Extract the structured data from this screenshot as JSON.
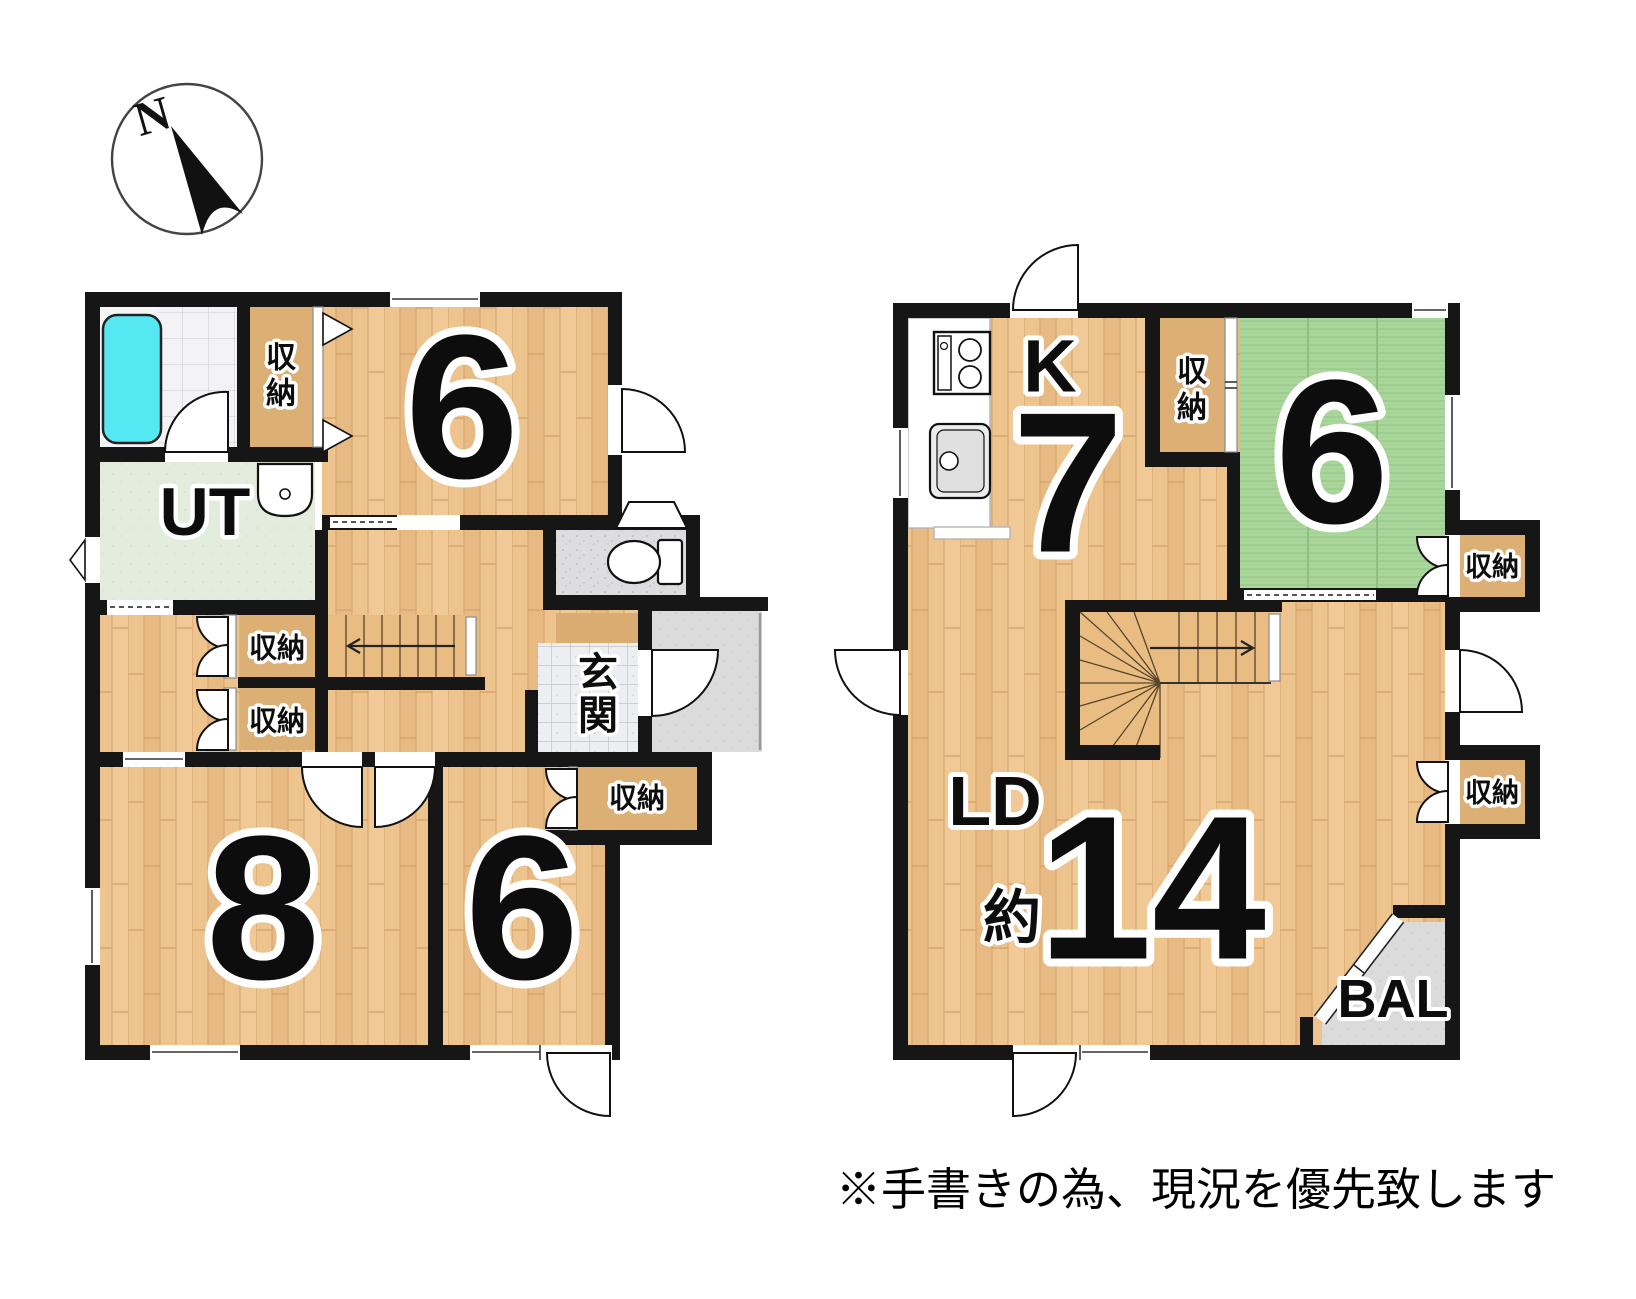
{
  "compass": {
    "north_label": "N"
  },
  "labels": {
    "storage": "収納",
    "storage_chars": [
      "収",
      "納"
    ],
    "entrance_chars": [
      "玄",
      "関"
    ],
    "utility": "UT",
    "kitchen": "K",
    "living_dining": "LD",
    "approx": "約",
    "balcony": "BAL"
  },
  "floor1": {
    "bedroom_top_size": "6",
    "bedroom_left_size": "8",
    "bedroom_right_size": "6"
  },
  "floor2": {
    "kitchen_size": "7",
    "tatami_size": "6",
    "living_size": "14"
  },
  "note": "※手書きの為、現況を優先致します",
  "colors": {
    "wall": "#161616",
    "wood": "#edc38e",
    "closet_wood": "#dcaf75",
    "stair_wood": "#e9bd82",
    "tatami": "#aad69b",
    "utility_floor": "#e4ecde",
    "bathtub": "#55e8f2",
    "porch": "#dbdbdb"
  }
}
